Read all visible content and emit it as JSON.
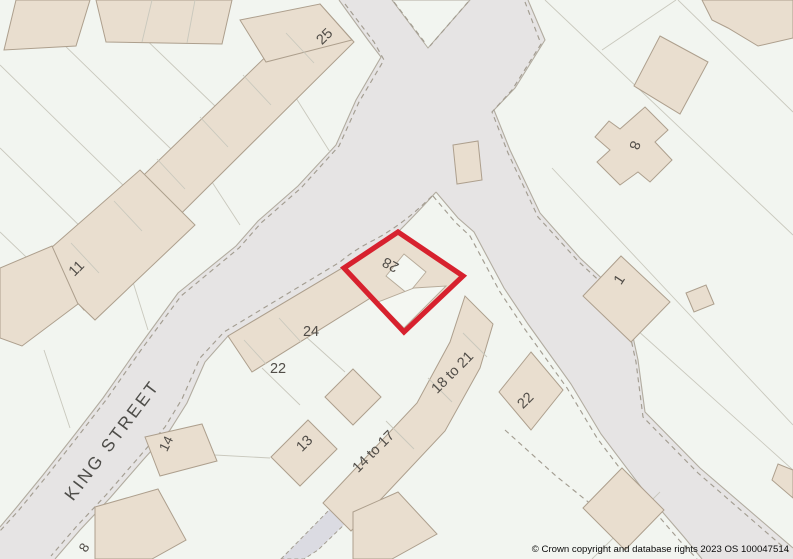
{
  "map": {
    "street_name": "KING STREET",
    "highlighted_plot_number": "28",
    "labels": {
      "n25": "25",
      "n11": "11",
      "n14_left": "14",
      "n8_left": "8",
      "n24": "24",
      "n22_left": "22",
      "n13": "13",
      "n14to17": "14 to 17",
      "n18to21": "18 to 21",
      "n22_right": "22",
      "n8_right": "8",
      "n1": "1"
    },
    "copyright": "© Crown copyright and database rights 2023 OS 100047514",
    "colors": {
      "highlight_outline": "#d7212e",
      "building_fill": "#e9decf",
      "road_fill": "#e6e4e4",
      "background": "#f2f5f0"
    }
  }
}
